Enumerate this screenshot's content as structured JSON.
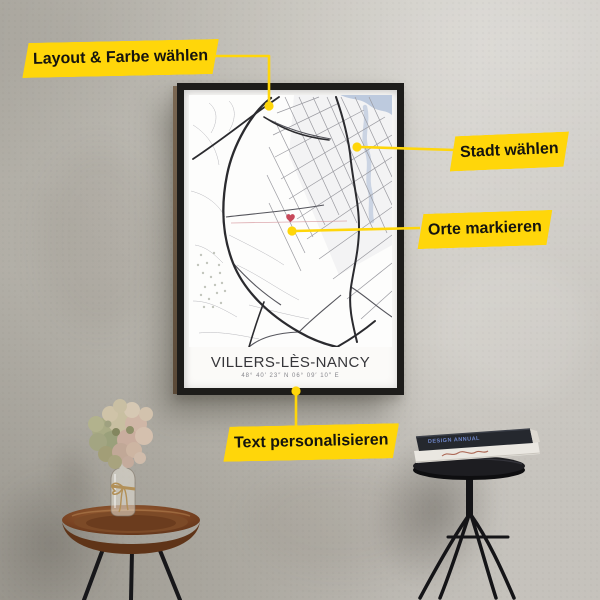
{
  "annotations": {
    "accent_color": "#ffd60a",
    "labels": [
      {
        "id": "layout-color",
        "text": "Layout & Farbe wählen"
      },
      {
        "id": "city",
        "text": "Stadt wählen"
      },
      {
        "id": "places",
        "text": "Orte markieren"
      },
      {
        "id": "personalize",
        "text": "Text personalisieren"
      }
    ]
  },
  "poster": {
    "title": "VILLERS-LÈS-NANCY",
    "coordinates": "48° 40′ 23″ N   06° 09′ 10″ E",
    "marker_icon": "heart-marker",
    "colors": {
      "frame": "#1d1c1a",
      "paper": "#fbfaf8",
      "roads_major": "#2b2b2f",
      "roads_minor": "#9a9aa0",
      "water": "#bdcade",
      "marker_red": "#c7495a"
    }
  },
  "props": {
    "books": {
      "top_spine_text": "DESIGN ANNUAL"
    }
  }
}
